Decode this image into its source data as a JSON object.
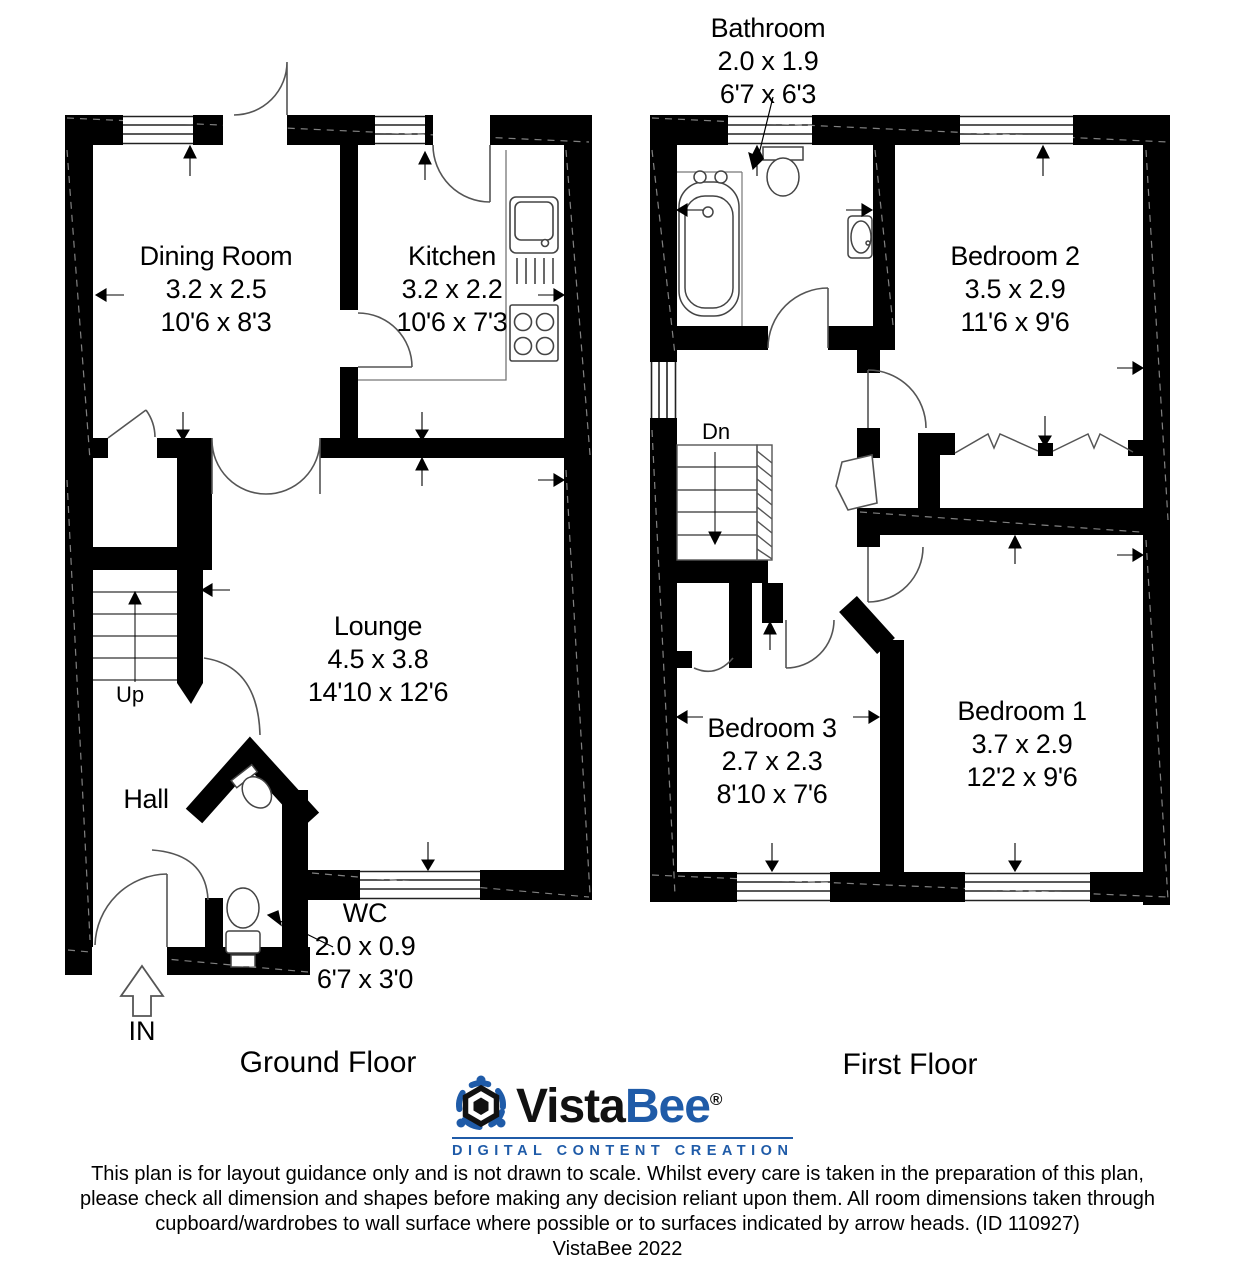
{
  "floors": [
    {
      "name": "Ground Floor",
      "stairs_label": "Up",
      "entrance_label": "IN",
      "rooms": [
        {
          "name": "Dining Room",
          "metric": "3.2 x 2.5",
          "imperial": "10'6 x 8'3"
        },
        {
          "name": "Kitchen",
          "metric": "3.2 x 2.2",
          "imperial": "10'6 x 7'3"
        },
        {
          "name": "Lounge",
          "metric": "4.5 x 3.8",
          "imperial": "14'10 x 12'6"
        },
        {
          "name": "Hall"
        },
        {
          "name": "WC",
          "metric": "2.0 x 0.9",
          "imperial": "6'7 x 3'0"
        }
      ]
    },
    {
      "name": "First Floor",
      "stairs_label": "Dn",
      "rooms": [
        {
          "name": "Bathroom",
          "metric": "2.0 x 1.9",
          "imperial": "6'7 x 6'3"
        },
        {
          "name": "Bedroom 2",
          "metric": "3.5 x 2.9",
          "imperial": "11'6 x 9'6"
        },
        {
          "name": "Bedroom 1",
          "metric": "3.7 x 2.9",
          "imperial": "12'2 x 9'6"
        },
        {
          "name": "Bedroom 3",
          "metric": "2.7 x 2.3",
          "imperial": "8'10 x 7'6"
        }
      ]
    }
  ],
  "logo": {
    "word_black": "Vista",
    "word_blue": "Bee",
    "registered": "®",
    "tagline": "DIGITAL CONTENT CREATION",
    "blue": "#1f5ba8"
  },
  "colors": {
    "wall": "#000000",
    "thin_line": "#4a4a4a",
    "logo_blue": "#1f5ba8"
  },
  "disclaimer": {
    "lines": [
      "This plan is for layout guidance only and is not drawn to scale. Whilst every care is taken in the preparation of this plan,",
      "please check all dimension and shapes before making any decision reliant upon them. All room dimensions taken through",
      "cupboard/wardrobes to wall surface where possible or to surfaces indicated by arrow heads. (ID 110927)",
      "VistaBee 2022"
    ]
  }
}
